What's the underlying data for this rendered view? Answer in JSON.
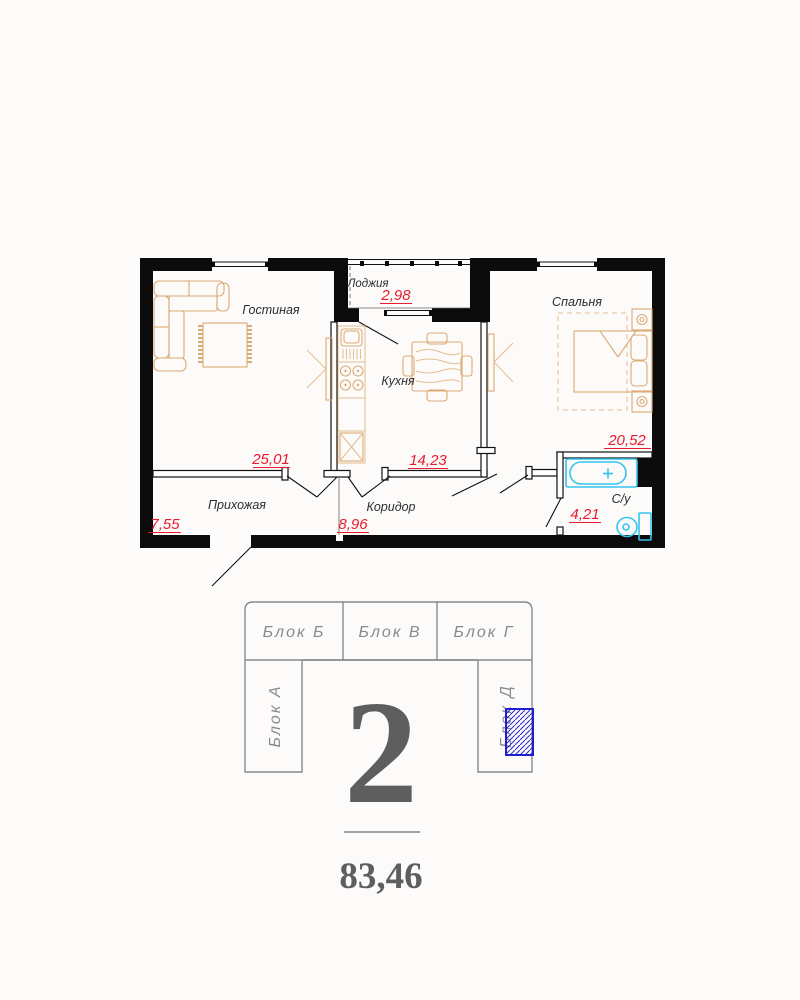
{
  "plan": {
    "rooms": [
      {
        "name": "Гостиная",
        "area": "25,01"
      },
      {
        "name": "Лоджия",
        "area": "2,98"
      },
      {
        "name": "Кухня",
        "area": "14,23"
      },
      {
        "name": "Спальня",
        "area": "20,52"
      },
      {
        "name": "Прихожая",
        "area": "7,55"
      },
      {
        "name": "Коридор",
        "area": "8,96"
      },
      {
        "name": "С/у",
        "area": "4,21"
      }
    ]
  },
  "diagram": {
    "blocks": [
      {
        "label": "Блок Б"
      },
      {
        "label": "Блок В"
      },
      {
        "label": "Блок Г"
      },
      {
        "label": "Блок А"
      },
      {
        "label": "Блок Д"
      }
    ],
    "apartment_number": "2",
    "total_area": "83,46"
  },
  "colors": {
    "area_red": "#e81c2e",
    "fixture_cyan": "#35c4ee",
    "furniture_tan": "#dcaa74",
    "highlight_blue": "#2020cc",
    "diagram_gray": "#8a8a8a",
    "wall_black": "#0b0b0b"
  }
}
